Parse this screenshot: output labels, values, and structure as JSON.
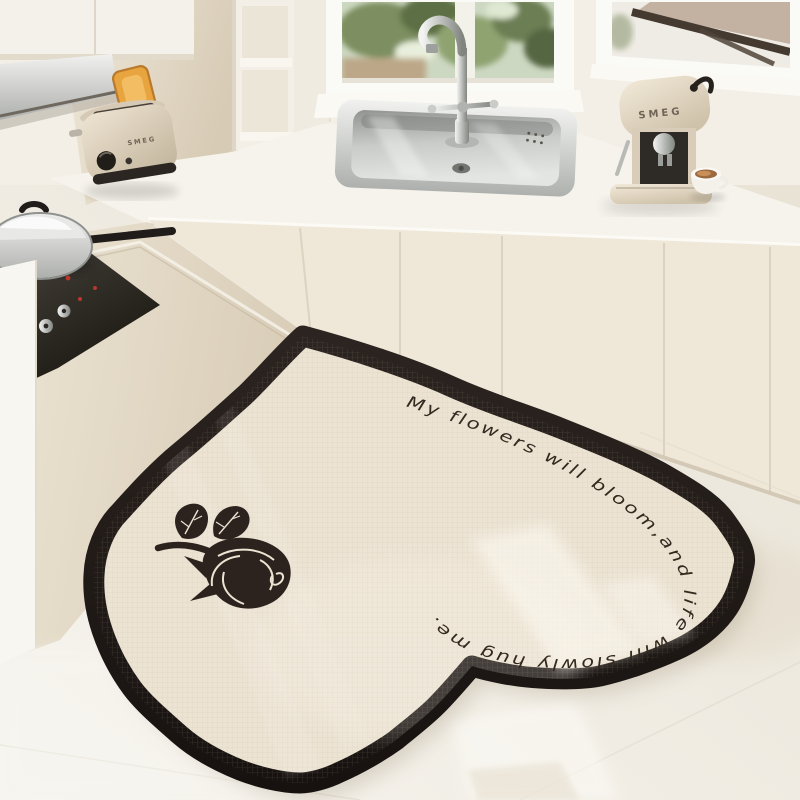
{
  "scene": {
    "description": "Cream minimalist kitchen corner with a heart-shaped anti-slip kitchen mat on the floor",
    "mat": {
      "quote": "My flowers will bloom,and life will slowly hug me.",
      "motif": "black-rose-silhouette",
      "border_color": "#201814",
      "surface_color": "#ece3d3"
    },
    "appliances": {
      "toaster_brand": "SMEG",
      "coffee_machine_brand": "SMEG"
    },
    "palette": {
      "cabinet_cream": "#efe8d9",
      "wall": "#f3efe7",
      "floor_light": "#f7f5f0",
      "floor_warm": "#e9e3d6",
      "stainless": "#c6c8c5",
      "toast": "#e7a43f",
      "greenery": "#6d7d52"
    }
  }
}
